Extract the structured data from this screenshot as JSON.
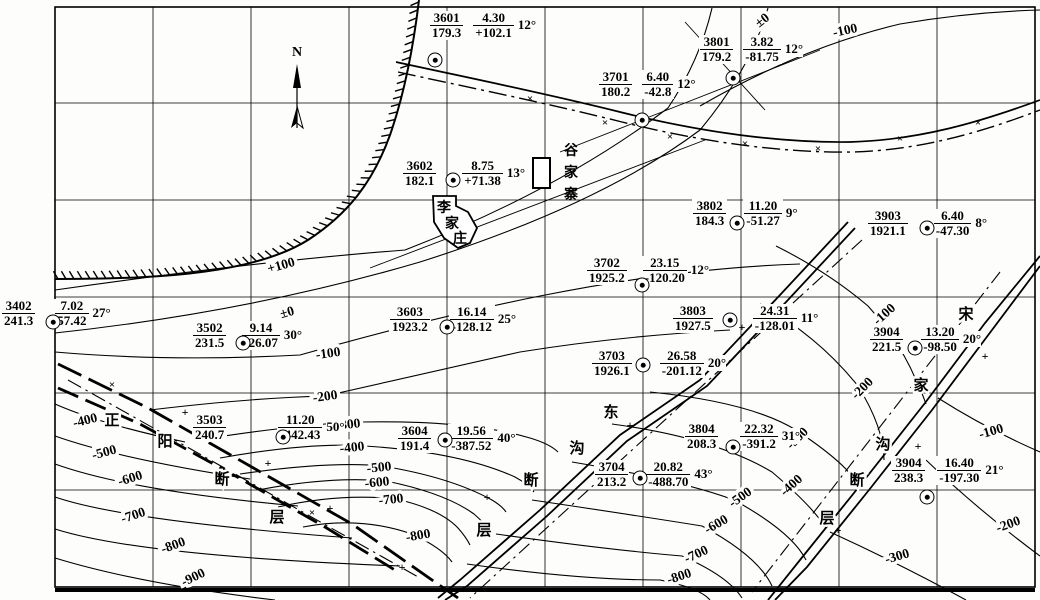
{
  "map": {
    "north_label": "N",
    "grid": {
      "vx": [
        55,
        153,
        251,
        349,
        447,
        545,
        643,
        741,
        839,
        937,
        1035
      ],
      "hy": [
        7,
        103,
        200,
        297,
        393,
        490,
        587
      ]
    },
    "colors": {
      "ink": "#000000",
      "paper": "#fdfdfb"
    },
    "villages": [
      {
        "name": "李家庄",
        "chars": [
          {
            "ch": "李",
            "x": 444,
            "y": 206
          },
          {
            "ch": "家",
            "x": 452,
            "y": 222
          },
          {
            "ch": "庄",
            "x": 460,
            "y": 237
          }
        ]
      },
      {
        "name": "谷家寨",
        "chars": [
          {
            "ch": "谷",
            "x": 571,
            "y": 149
          },
          {
            "ch": "家",
            "x": 571,
            "y": 171
          },
          {
            "ch": "寨",
            "x": 571,
            "y": 193
          }
        ]
      }
    ],
    "faults": [
      {
        "name": "正阳断层",
        "chars": [
          {
            "ch": "正",
            "x": 112,
            "y": 419
          },
          {
            "ch": "阳",
            "x": 165,
            "y": 440
          },
          {
            "ch": "断",
            "x": 222,
            "y": 478
          },
          {
            "ch": "层",
            "x": 277,
            "y": 516
          }
        ]
      },
      {
        "name": "东沟断层",
        "chars": [
          {
            "ch": "东",
            "x": 611,
            "y": 411
          },
          {
            "ch": "沟",
            "x": 577,
            "y": 447
          },
          {
            "ch": "断",
            "x": 531,
            "y": 479
          },
          {
            "ch": "层",
            "x": 484,
            "y": 529
          }
        ]
      },
      {
        "name": "宋家沟断层",
        "chars": [
          {
            "ch": "宋",
            "x": 966,
            "y": 313
          },
          {
            "ch": "家",
            "x": 921,
            "y": 384
          },
          {
            "ch": "沟",
            "x": 883,
            "y": 443
          },
          {
            "ch": "断",
            "x": 857,
            "y": 479
          },
          {
            "ch": "层",
            "x": 827,
            "y": 517
          }
        ]
      }
    ],
    "stations": [
      {
        "id": "3601",
        "elev": "179.3",
        "thick": "4.30",
        "floor": "+102.1",
        "dip": "12°",
        "dot": [
          435,
          60
        ],
        "label": [
          429,
          11
        ],
        "gap": 8
      },
      {
        "id": "3701",
        "elev": "180.2",
        "thick": "6.40",
        "floor": "-42.8",
        "dip": "12°",
        "dot": [
          642,
          120
        ],
        "label": [
          598,
          70
        ],
        "gap": 8
      },
      {
        "id": "3801",
        "elev": "179.2",
        "thick": "3.82",
        "floor": "-81.75",
        "dip": "12°",
        "dot": [
          733,
          78
        ],
        "label": [
          699,
          35
        ],
        "gap": 8
      },
      {
        "id": "3602",
        "elev": "182.1",
        "thick": "8.75",
        "floor": "+71.38",
        "dip": "13°",
        "dot": [
          453,
          180
        ],
        "label": [
          402,
          159
        ],
        "gap": 24
      },
      {
        "id": "3802",
        "elev": "184.3",
        "thick": "11.20",
        "floor": "-51.27",
        "dip": "9°",
        "dot": [
          737,
          223
        ],
        "label": [
          692,
          199
        ],
        "gap": 16
      },
      {
        "id": "3903",
        "elev": "1921.1",
        "thick": "6.40",
        "floor": "-47.30",
        "dip": "8°",
        "dot": [
          927,
          228
        ],
        "label": [
          867,
          209
        ],
        "gap": 24
      },
      {
        "id": "3702",
        "elev": "1925.2",
        "thick": "23.15",
        "floor": "-120.20",
        "dip": "12°",
        "dot": [
          642,
          285
        ],
        "label": [
          586,
          256
        ],
        "gap": 14
      },
      {
        "id": "3402",
        "elev": "241.3",
        "thick": "7.02",
        "floor": "57.42",
        "dip": "27°",
        "dot": [
          53,
          322
        ],
        "label": [
          1,
          299
        ],
        "gap": 18
      },
      {
        "id": "3502",
        "elev": "231.5",
        "thick": "9.14",
        "floor": "-26.07",
        "dip": "30°",
        "dot": [
          243,
          343
        ],
        "label": [
          192,
          321
        ],
        "gap": 14
      },
      {
        "id": "3603",
        "elev": "1923.2",
        "thick": "16.14",
        "floor": "-128.12",
        "dip": "25°",
        "dot": [
          447,
          327
        ],
        "label": [
          389,
          305
        ],
        "gap": 18
      },
      {
        "id": "3803",
        "elev": "1927.5",
        "thick": "24.31",
        "floor": "-128.01",
        "dip": "11°",
        "dot": [
          730,
          320
        ],
        "label": [
          672,
          304
        ],
        "gap": 38
      },
      {
        "id": "3904",
        "elev": "221.5",
        "thick": "13.20",
        "floor": "-98.50",
        "dip": "20°",
        "dot": [
          915,
          348
        ],
        "label": [
          869,
          325
        ],
        "gap": 16
      },
      {
        "id": "3703",
        "elev": "1926.1",
        "thick": "26.58",
        "floor": "-201.12",
        "dip": "20°",
        "dot": [
          643,
          365
        ],
        "label": [
          591,
          349
        ],
        "gap": 26
      },
      {
        "id": "3503",
        "elev": "240.7",
        "thick": "11.20",
        "floor": "-442.43",
        "dip": "50°",
        "dot": [
          283,
          437
        ],
        "label": [
          192,
          413
        ],
        "gap": 50
      },
      {
        "id": "3604",
        "elev": "191.4",
        "thick": "19.56",
        "floor": "-387.52",
        "dip": "40°",
        "dot": [
          445,
          440
        ],
        "label": [
          397,
          424
        ],
        "gap": 16
      },
      {
        "id": "3804",
        "elev": "208.3",
        "thick": "22.32",
        "floor": "-391.2",
        "dip": "31°",
        "dot": [
          733,
          447
        ],
        "label": [
          684,
          422
        ],
        "gap": 20
      },
      {
        "id": "3704",
        "elev": "213.2",
        "thick": "20.82",
        "floor": "-488.70",
        "dip": "43°",
        "dot": [
          640,
          478
        ],
        "label": [
          594,
          460
        ],
        "gap": 16
      },
      {
        "id": "3904",
        "elev": "238.3",
        "thick": "16.40",
        "floor": "-197.30",
        "dip": "21°",
        "dot": [
          927,
          497
        ],
        "label": [
          891,
          456
        ],
        "gap": 10
      }
    ],
    "contour_labels": [
      {
        "text": "+100",
        "x": 281,
        "y": 265,
        "rot": -16
      },
      {
        "text": "±0",
        "x": 287,
        "y": 312,
        "rot": -16
      },
      {
        "text": "±0",
        "x": 762,
        "y": 20,
        "rot": -38
      },
      {
        "text": "-100",
        "x": 845,
        "y": 30,
        "rot": -12
      },
      {
        "text": "-100",
        "x": 328,
        "y": 353,
        "rot": -8
      },
      {
        "text": "-200",
        "x": 325,
        "y": 396,
        "rot": -8
      },
      {
        "text": "-100",
        "x": 884,
        "y": 314,
        "rot": -42
      },
      {
        "text": "-200",
        "x": 862,
        "y": 388,
        "rot": -45
      },
      {
        "text": "-100",
        "x": 991,
        "y": 431,
        "rot": -16
      },
      {
        "text": "-200",
        "x": 1008,
        "y": 524,
        "rot": -20
      },
      {
        "text": "-300",
        "x": 897,
        "y": 556,
        "rot": -16
      },
      {
        "text": "-300",
        "x": 348,
        "y": 424,
        "rot": -6
      },
      {
        "text": "-400",
        "x": 352,
        "y": 447,
        "rot": -6
      },
      {
        "text": "-500",
        "x": 379,
        "y": 467,
        "rot": -6
      },
      {
        "text": "-600",
        "x": 377,
        "y": 482,
        "rot": -6
      },
      {
        "text": "-700",
        "x": 391,
        "y": 499,
        "rot": -6
      },
      {
        "text": "-800",
        "x": 418,
        "y": 535,
        "rot": -10
      },
      {
        "text": "-300",
        "x": 797,
        "y": 438,
        "rot": -45
      },
      {
        "text": "-400",
        "x": 791,
        "y": 485,
        "rot": -42
      },
      {
        "text": "-500",
        "x": 740,
        "y": 497,
        "rot": -35
      },
      {
        "text": "-600",
        "x": 716,
        "y": 524,
        "rot": -30
      },
      {
        "text": "-700",
        "x": 696,
        "y": 554,
        "rot": -25
      },
      {
        "text": "-800",
        "x": 679,
        "y": 576,
        "rot": -18
      },
      {
        "text": "-400",
        "x": 85,
        "y": 420,
        "rot": -14
      },
      {
        "text": "-500",
        "x": 104,
        "y": 452,
        "rot": -15
      },
      {
        "text": "-600",
        "x": 130,
        "y": 478,
        "rot": -17
      },
      {
        "text": "-700",
        "x": 133,
        "y": 515,
        "rot": -18
      },
      {
        "text": "-800",
        "x": 173,
        "y": 545,
        "rot": -20
      },
      {
        "text": "-900",
        "x": 193,
        "y": 577,
        "rot": -26
      }
    ],
    "marks": {
      "cross": [
        [
          112,
          384
        ],
        [
          205,
          438
        ],
        [
          312,
          512
        ],
        [
          530,
          98
        ],
        [
          605,
          122
        ],
        [
          670,
          136
        ],
        [
          745,
          143
        ],
        [
          818,
          148
        ],
        [
          900,
          138
        ],
        [
          978,
          122
        ]
      ],
      "plus": [
        [
          185,
          412
        ],
        [
          268,
          463
        ],
        [
          330,
          508
        ],
        [
          402,
          567
        ],
        [
          742,
          327
        ],
        [
          630,
          425
        ],
        [
          487,
          497
        ],
        [
          985,
          356
        ],
        [
          918,
          446
        ],
        [
          838,
          530
        ]
      ]
    }
  }
}
